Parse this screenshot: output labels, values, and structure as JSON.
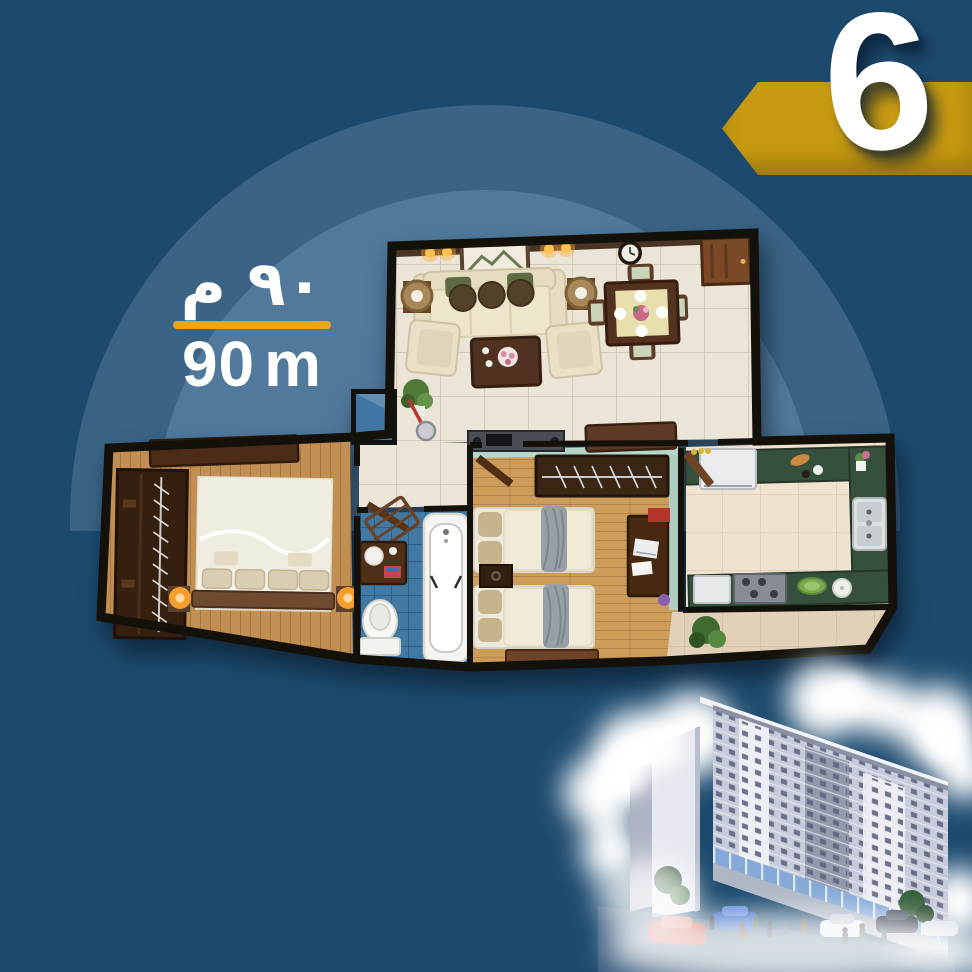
{
  "canvas": {
    "background_color": "#1C4A6E"
  },
  "dome": {
    "outer_color": "#3A6385",
    "inner_color": "#50799B"
  },
  "unit_badge": {
    "number": "6",
    "ribbon_color": "#C79A12",
    "number_color": "#FFFFFF"
  },
  "area_label": {
    "arabic_value": "٩٠ م",
    "latin_value": "90",
    "latin_unit": "m",
    "divider_color": "#E9A71B",
    "text_color": "#FFFFFF"
  },
  "floor_plan": {
    "wall_color": "#14100A",
    "counter_color": "#35503C",
    "rooms": {
      "living_dining": {
        "floor_color": "#EAE5D6"
      },
      "master_bedroom": {
        "floor_color": "#C28F52"
      },
      "kids_bedroom": {
        "floor_color": "#CD9C59"
      },
      "bathroom": {
        "floor_color": "#4279A3"
      },
      "kitchen": {
        "floor_color": "#EFE2CE"
      },
      "balcony": {
        "floor_color": "#E2D0B8"
      }
    }
  },
  "building": {
    "front_color": "#C7CBDB",
    "side_color": "#E6E8EF",
    "window_color": "#5E657F",
    "glass_color": "#83A9D8",
    "cloud_color": "#FFFFFF",
    "car_colors": {
      "red": "#C23B2A",
      "blue": "#2A5FC4",
      "white": "#E8EAEE",
      "dark": "#2B3440"
    }
  }
}
